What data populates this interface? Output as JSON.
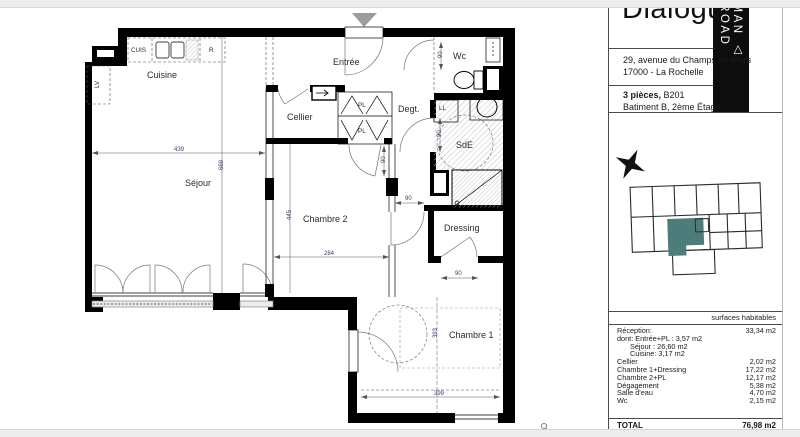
{
  "header": {
    "title": "Dialogue",
    "logo_vertical": "FMAN △ BROAD"
  },
  "address": {
    "line1": "29, avenue du Champs de Mars",
    "line2": "17000 -   La Rochelle"
  },
  "unit": {
    "type": "3 pièces,",
    "number": "B201",
    "floor": "Batiment B, 2ème Étage"
  },
  "plan": {
    "rooms": {
      "cuisine": "Cuisine",
      "sejour": "Séjour",
      "entree": "Entrée",
      "cellier": "Cellier",
      "pl1": "PL",
      "pl2": "PL",
      "degt": "Degt.",
      "wc": "Wc",
      "sde": "SdE",
      "ll": "LL",
      "dressing": "Dressing",
      "chambre2": "Chambre 2",
      "chambre1": "Chambre 1",
      "cuis": "CUIS",
      "r": "R",
      "lv": "LV"
    },
    "dims": {
      "sejour_w": "439",
      "sejour_h": "669",
      "chambre2_w": "284",
      "chambre2_h": "445",
      "chambre1_h": "393",
      "chambre1_w": "399",
      "door": "90"
    }
  },
  "areas": {
    "header_label": "surfaces habitables",
    "rows": [
      {
        "label": "Réception:",
        "value": "33,34 m2"
      },
      {
        "label": "dont: Entrée+PL : 3,57 m2",
        "value": ""
      },
      {
        "label": "Séjour : 26,60 m2",
        "value": ""
      },
      {
        "label": "Cuisine: 3,17 m2",
        "value": ""
      },
      {
        "label": "Cellier",
        "value": "2,02 m2"
      },
      {
        "label": "Chambre 1+Dressing",
        "value": "17,22 m2"
      },
      {
        "label": "Chambre 2+PL",
        "value": "12,17 m2"
      },
      {
        "label": "Dégagement",
        "value": "5,38 m2"
      },
      {
        "label": "Salle d'eau",
        "value": "4,70 m2"
      },
      {
        "label": "Wc",
        "value": "2,15 m2"
      }
    ],
    "total_label": "TOTAL",
    "total_value": "76,98 m2"
  },
  "colors": {
    "accent_teal": "#4d7d7a",
    "wall": "#000000",
    "dim_text": "#3a3a6b"
  }
}
